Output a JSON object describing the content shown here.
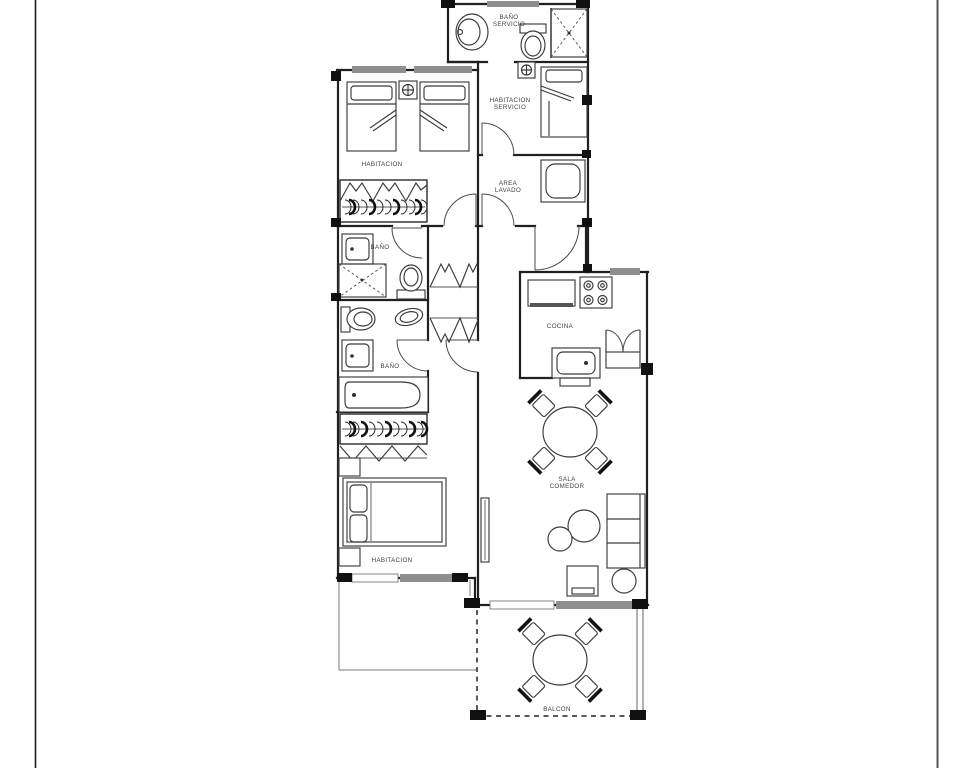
{
  "canvas": {
    "width": 968,
    "height": 768,
    "background": "#ffffff"
  },
  "palette": {
    "wall": "#202020",
    "furniture_line": "#3a3a3a",
    "door_line": "#4a4a4a",
    "window_bar": "#8f8f8f",
    "column_marker": "#111111",
    "label_text": "#3f3f3f",
    "page_edge": "#333333"
  },
  "floor_plan": {
    "type": "apartment-floor-plan",
    "labels": {
      "bano_servicio_line1": "BAÑO",
      "bano_servicio_line2": "SERVICIO",
      "habitacion_servicio_line1": "HABITACION",
      "habitacion_servicio_line2": "SERVICIO",
      "habitacion_top": "HABITACION",
      "area_lavado_line1": "AREA",
      "area_lavado_line2": "LAVADO",
      "bano_medio": "BAÑO",
      "bano_principal": "BAÑO",
      "cocina": "COCINA",
      "sala_line1": "SALA",
      "sala_line2": "COMEDOR",
      "habitacion_principal": "HABITACION",
      "balcon": "BALCON"
    }
  }
}
